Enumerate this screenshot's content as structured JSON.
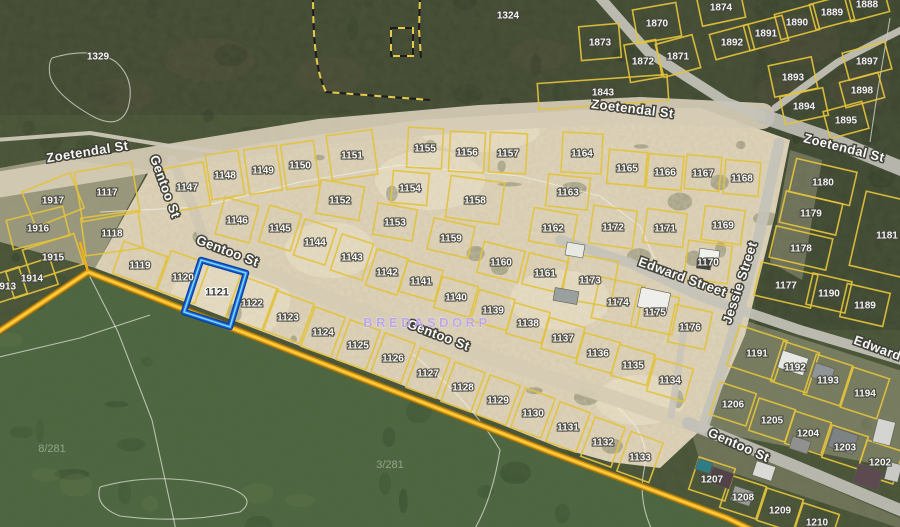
{
  "map": {
    "place_label": "BREDASDORP",
    "area_labels": [
      {
        "text": "8/281",
        "x": 52,
        "y": 452
      },
      {
        "text": "3/281",
        "x": 390,
        "y": 468
      }
    ],
    "selected_parcel": {
      "number": "1121",
      "points": "201,260 246,273 230,327 184,312",
      "label_x": 217,
      "label_y": 292
    },
    "street_labels": [
      {
        "text": "Zoetendal St",
        "x": 88,
        "y": 156,
        "rot": -9
      },
      {
        "text": "Zoetendal St",
        "x": 632,
        "y": 113,
        "rot": 7
      },
      {
        "text": "Zoetendal St",
        "x": 843,
        "y": 152,
        "rot": 14
      },
      {
        "text": "Gentoo St",
        "x": 161,
        "y": 188,
        "rot": 70
      },
      {
        "text": "Gentoo St",
        "x": 226,
        "y": 255,
        "rot": 21
      },
      {
        "text": "Gentoo St",
        "x": 437,
        "y": 339,
        "rot": 21
      },
      {
        "text": "Gentoo St",
        "x": 737,
        "y": 449,
        "rot": 24
      },
      {
        "text": "Edward Street",
        "x": 681,
        "y": 281,
        "rot": 20
      },
      {
        "text": "Edward",
        "x": 876,
        "y": 352,
        "rot": 20
      },
      {
        "text": "Jessie Street",
        "x": 744,
        "y": 284,
        "rot": -72
      }
    ],
    "parcels": [
      [
        1329,
        98,
        56,
        0,
        0,
        0
      ],
      [
        1324,
        508,
        15,
        0,
        0,
        0
      ],
      [
        1870,
        657,
        23,
        44,
        34,
        -10
      ],
      [
        1873,
        600,
        42,
        40,
        34,
        -5
      ],
      [
        1874,
        721,
        7,
        44,
        30,
        -12
      ],
      [
        1871,
        678,
        56,
        38,
        34,
        -15
      ],
      [
        1872,
        643,
        61,
        32,
        38,
        -10
      ],
      [
        1892,
        732,
        42,
        40,
        26,
        -15
      ],
      [
        1891,
        766,
        33,
        40,
        26,
        -15
      ],
      [
        1890,
        797,
        22,
        40,
        26,
        -15
      ],
      [
        1889,
        832,
        12,
        40,
        26,
        -15
      ],
      [
        1888,
        867,
        4,
        40,
        26,
        -15
      ],
      [
        1897,
        867,
        61,
        44,
        28,
        -15
      ],
      [
        1898,
        862,
        90,
        40,
        26,
        -15
      ],
      [
        1893,
        793,
        77,
        44,
        32,
        -12
      ],
      [
        1894,
        804,
        106,
        44,
        28,
        -12
      ],
      [
        1895,
        846,
        120,
        40,
        28,
        -15
      ],
      [
        1843,
        603,
        92,
        130,
        26,
        -4
      ],
      [
        1917,
        53,
        200,
        52,
        38,
        -22
      ],
      [
        1916,
        38,
        228,
        58,
        30,
        -14
      ],
      [
        1915,
        53,
        257,
        54,
        32,
        -18
      ],
      [
        1914,
        32,
        278,
        46,
        28,
        -18
      ],
      [
        1913,
        5,
        286,
        38,
        28,
        -18
      ],
      [
        1117,
        107,
        192,
        58,
        50,
        -10
      ],
      [
        1118,
        112,
        233,
        58,
        38,
        -8
      ],
      [
        1147,
        187,
        187,
        40,
        44,
        -10
      ],
      [
        1148,
        225,
        175,
        33,
        45,
        -9
      ],
      [
        1149,
        263,
        170,
        33,
        45,
        -8
      ],
      [
        1150,
        300,
        165,
        33,
        45,
        -8
      ],
      [
        1151,
        352,
        155,
        46,
        45,
        -8
      ],
      [
        1146,
        237,
        220,
        35,
        38,
        15
      ],
      [
        1145,
        280,
        228,
        33,
        38,
        17
      ],
      [
        1144,
        315,
        242,
        33,
        38,
        18
      ],
      [
        1143,
        352,
        257,
        33,
        38,
        18
      ],
      [
        1142,
        387,
        272,
        33,
        38,
        18
      ],
      [
        1152,
        340,
        200,
        44,
        34,
        10
      ],
      [
        1153,
        395,
        222,
        40,
        32,
        10
      ],
      [
        1154,
        410,
        188,
        36,
        32,
        5
      ],
      [
        1155,
        425,
        148,
        35,
        40,
        3
      ],
      [
        1156,
        467,
        152,
        35,
        40,
        3
      ],
      [
        1157,
        508,
        153,
        37,
        40,
        3
      ],
      [
        1158,
        475,
        200,
        54,
        42,
        8
      ],
      [
        1159,
        451,
        238,
        42,
        32,
        13
      ],
      [
        1160,
        501,
        262,
        42,
        32,
        14
      ],
      [
        1161,
        545,
        273,
        40,
        32,
        14
      ],
      [
        1162,
        553,
        228,
        44,
        34,
        10
      ],
      [
        1163,
        568,
        192,
        42,
        32,
        6
      ],
      [
        1164,
        582,
        153,
        40,
        40,
        3
      ],
      [
        1165,
        627,
        168,
        38,
        34,
        5
      ],
      [
        1166,
        665,
        172,
        35,
        34,
        5
      ],
      [
        1167,
        703,
        173,
        35,
        34,
        5
      ],
      [
        1168,
        742,
        178,
        35,
        34,
        5
      ],
      [
        1169,
        723,
        225,
        40,
        34,
        8
      ],
      [
        1170,
        708,
        262,
        44,
        38,
        8
      ],
      [
        1171,
        665,
        228,
        40,
        34,
        8
      ],
      [
        1172,
        613,
        227,
        44,
        38,
        8
      ],
      [
        1141,
        421,
        281,
        37,
        32,
        16
      ],
      [
        1140,
        456,
        297,
        37,
        32,
        16
      ],
      [
        1139,
        493,
        310,
        37,
        32,
        16
      ],
      [
        1138,
        528,
        323,
        37,
        32,
        16
      ],
      [
        1137,
        563,
        338,
        37,
        32,
        16
      ],
      [
        1136,
        598,
        353,
        37,
        32,
        16
      ],
      [
        1135,
        633,
        365,
        37,
        32,
        16
      ],
      [
        1134,
        670,
        380,
        39,
        34,
        16
      ],
      [
        1119,
        140,
        265,
        46,
        34,
        20
      ],
      [
        1120,
        183,
        277,
        40,
        42,
        20
      ],
      [
        1121,
        217,
        292,
        0,
        0,
        0
      ],
      [
        1122,
        252,
        303,
        40,
        44,
        20
      ],
      [
        1123,
        288,
        317,
        40,
        42,
        20
      ],
      [
        1124,
        323,
        332,
        32,
        42,
        20
      ],
      [
        1125,
        358,
        345,
        32,
        42,
        20
      ],
      [
        1126,
        393,
        358,
        32,
        42,
        20
      ],
      [
        1127,
        428,
        373,
        32,
        42,
        20
      ],
      [
        1128,
        463,
        387,
        32,
        42,
        20
      ],
      [
        1129,
        498,
        400,
        32,
        42,
        20
      ],
      [
        1130,
        533,
        413,
        32,
        42,
        20
      ],
      [
        1131,
        568,
        427,
        32,
        42,
        20
      ],
      [
        1132,
        603,
        442,
        32,
        42,
        20
      ],
      [
        1133,
        640,
        457,
        34,
        42,
        20
      ],
      [
        1180,
        823,
        182,
        62,
        34,
        13
      ],
      [
        1179,
        811,
        213,
        58,
        32,
        13
      ],
      [
        1178,
        801,
        248,
        58,
        32,
        13
      ],
      [
        1177,
        786,
        285,
        58,
        34,
        13
      ],
      [
        1181,
        887,
        235,
        60,
        76,
        13
      ],
      [
        1190,
        829,
        293,
        40,
        32,
        13
      ],
      [
        1189,
        865,
        305,
        44,
        34,
        13
      ],
      [
        1173,
        590,
        280,
        50,
        46,
        10
      ],
      [
        1174,
        618,
        302,
        46,
        42,
        12
      ],
      [
        1175,
        655,
        312,
        42,
        38,
        12
      ],
      [
        1176,
        690,
        327,
        38,
        38,
        12
      ],
      [
        1191,
        757,
        353,
        50,
        42,
        18
      ],
      [
        1192,
        795,
        367,
        38,
        42,
        18
      ],
      [
        1193,
        828,
        380,
        38,
        42,
        18
      ],
      [
        1194,
        865,
        393,
        38,
        42,
        18
      ],
      [
        1206,
        733,
        404,
        38,
        34,
        18
      ],
      [
        1205,
        772,
        420,
        38,
        34,
        18
      ],
      [
        1204,
        808,
        433,
        38,
        34,
        18
      ],
      [
        1203,
        845,
        447,
        38,
        34,
        18
      ],
      [
        1202,
        880,
        462,
        38,
        34,
        18
      ],
      [
        1207,
        712,
        479,
        38,
        34,
        18
      ],
      [
        1208,
        743,
        497,
        38,
        34,
        18
      ],
      [
        1209,
        780,
        510,
        38,
        34,
        18
      ],
      [
        1210,
        817,
        522,
        38,
        28,
        18
      ]
    ],
    "roads": [
      {
        "name": "zoetendal-band",
        "d": "M -10 186 L 150 160 L 320 132 L 480 118 L 640 110 L 762 116",
        "w": 26,
        "c": "#d6ccb6"
      },
      {
        "name": "zoetendal-east",
        "d": "M 762 116 L 832 140 L 905 170",
        "w": 15,
        "c": "#bfbeb6"
      },
      {
        "name": "topright-road-a",
        "d": "M 598 -5 L 648 52 L 726 102 L 762 116",
        "w": 10,
        "c": "#c6c3b9"
      },
      {
        "name": "topright-road-b",
        "d": "M 905 28 L 838 62 L 775 108",
        "w": 7,
        "c": "#c6c3b9"
      },
      {
        "name": "topleft-path",
        "d": "M -5 140 L 90 133 L 170 146 L 220 152",
        "w": 4,
        "c": "#d0cabb"
      },
      {
        "name": "gentoo-west",
        "d": "M 172 160 L 192 205 L 208 250",
        "w": 10,
        "c": "#d0c8b4"
      },
      {
        "name": "gentoo-diagonal",
        "d": "M 208 250 L 350 307 L 500 361 L 620 400 L 688 423",
        "w": 15,
        "c": "#d6ccb4"
      },
      {
        "name": "gentoo-southeast",
        "d": "M 688 423 L 790 464 L 905 512",
        "w": 12,
        "c": "#c0bfb7"
      },
      {
        "name": "jessie-street",
        "d": "M 779 143 L 757 245 L 728 352 L 703 428",
        "w": 11,
        "c": "#c4c2b9"
      },
      {
        "name": "edward-street",
        "d": "M 560 240 L 630 263 L 702 297 L 800 330 L 905 361",
        "w": 10,
        "c": "#c4c2b9"
      },
      {
        "name": "edward-connector",
        "d": "M 684 330 L 677 378 L 671 416",
        "w": 7,
        "c": "#cac6ba"
      }
    ],
    "contours": [
      "M 52 58 Q 92 46 116 62 Q 136 80 128 108 Q 120 130 94 117 Q 56 96 50 76 Q 48 64 52 58",
      "M 88 273 L 118 332 L 152 420 L 176 530",
      "M 100 212 L 200 207 L 300 182 L 400 165 L 520 176 L 600 196 L 640 226 L 656 262",
      "M -5 358 L 80 338 L 150 315",
      "M 410 352 Q 470 400 500 450 Q 492 500 474 530",
      "M 100 487 Q 160 470 230 488 Q 258 499 240 512 Q 180 524 120 516 Q 94 506 100 487",
      "M 890 18 L 877 95 L 870 142",
      "M 618 408 Q 652 436 644 470 Q 638 500 652 530"
    ],
    "dashed_boundaries": [
      "M 313 -5 C 313 40 316 72 326 92 L 430 100",
      "M 420 -5 L 419 30 L 421 58",
      "M 391 28 h 22 v 28 h -22 Z"
    ],
    "farm_boundary": {
      "main": "M -8 336 L 88 272 L 550 452 L 727 518 L 752 530",
      "spur": "M 88 272 L 80 242"
    },
    "buildings": [
      {
        "x": 575,
        "y": 250,
        "w": 18,
        "h": 13,
        "a": 10,
        "c": "#e9e9e4"
      },
      {
        "x": 566,
        "y": 296,
        "w": 24,
        "h": 13,
        "a": 10,
        "c": "#9aa09e"
      },
      {
        "x": 654,
        "y": 300,
        "w": 30,
        "h": 20,
        "a": 12,
        "c": "#eeeeea"
      },
      {
        "x": 709,
        "y": 256,
        "w": 20,
        "h": 13,
        "a": 8,
        "c": "#f0f0ec"
      },
      {
        "x": 704,
        "y": 264,
        "w": 14,
        "h": 10,
        "a": 8,
        "c": "#3f4446"
      },
      {
        "x": 793,
        "y": 363,
        "w": 27,
        "h": 18,
        "a": 18,
        "c": "#e6e6e2"
      },
      {
        "x": 823,
        "y": 373,
        "w": 20,
        "h": 15,
        "a": 18,
        "c": "#8f9496"
      },
      {
        "x": 843,
        "y": 441,
        "w": 26,
        "h": 20,
        "a": 18,
        "c": "#7d8284"
      },
      {
        "x": 800,
        "y": 445,
        "w": 19,
        "h": 13,
        "a": 18,
        "c": "#90918f"
      },
      {
        "x": 704,
        "y": 466,
        "w": 15,
        "h": 11,
        "a": 18,
        "c": "#2e7d86"
      },
      {
        "x": 721,
        "y": 478,
        "w": 22,
        "h": 16,
        "a": 18,
        "c": "#54424a"
      },
      {
        "x": 764,
        "y": 471,
        "w": 20,
        "h": 15,
        "a": 18,
        "c": "#dadad6"
      },
      {
        "x": 868,
        "y": 477,
        "w": 26,
        "h": 20,
        "a": 18,
        "c": "#5c4a50"
      },
      {
        "x": 884,
        "y": 432,
        "w": 18,
        "h": 24,
        "a": 14,
        "c": "#d4d4d0"
      },
      {
        "x": 893,
        "y": 472,
        "w": 14,
        "h": 18,
        "a": 14,
        "c": "#c9c9c5"
      },
      {
        "x": 742,
        "y": 496,
        "w": 20,
        "h": 15,
        "a": 18,
        "c": "#9b9b97"
      }
    ],
    "sand_main_polygon": "95,268 150,170 250,145 420,120 610,108 700,108 790,140 775,215 745,335 706,425 660,468 610,462 560,448 420,392 300,346 180,300",
    "sand_patches": [
      {
        "points": "0,168 55,158 148,170 95,268 30,250 0,242",
        "opacity": 0.55
      },
      {
        "points": "790,150 822,160 802,280 770,262",
        "opacity": 0.3
      },
      {
        "points": "712,310 905,372 905,470 695,428",
        "opacity": 0.32
      },
      {
        "points": "690,428 905,520 905,530 700,462",
        "opacity": 0.25
      }
    ]
  },
  "colors": {
    "base_veg": "#4a5438",
    "top_veg": "#444b34",
    "ne_veg": "#3d4430",
    "green_field": "#4d6741",
    "sand": "#d8cdb2",
    "sand_bright": "#e6dcc2",
    "parcel_line": "#e3c23c",
    "boundary_orange_dark": "#9c7210",
    "boundary_orange": "#f2ae19",
    "boundary_orange_core": "#ffd34d",
    "dashed_black": "#1d1d1d",
    "dashed_yellow": "#e8c94a",
    "highlight_outer": "#083f9e",
    "highlight_mid": "#1a6ae0",
    "highlight_core": "#7fd4f2",
    "label_fill": "#ffffff",
    "label_halo": "#44443c",
    "selected_label_fill": "#2e2e2e",
    "street_fill": "#fdfdfb",
    "street_halo": "#3f3f38",
    "place_fill": "#b9a3e6",
    "area_fill": "#ccd2c6",
    "contour": "#f2f1ea"
  }
}
